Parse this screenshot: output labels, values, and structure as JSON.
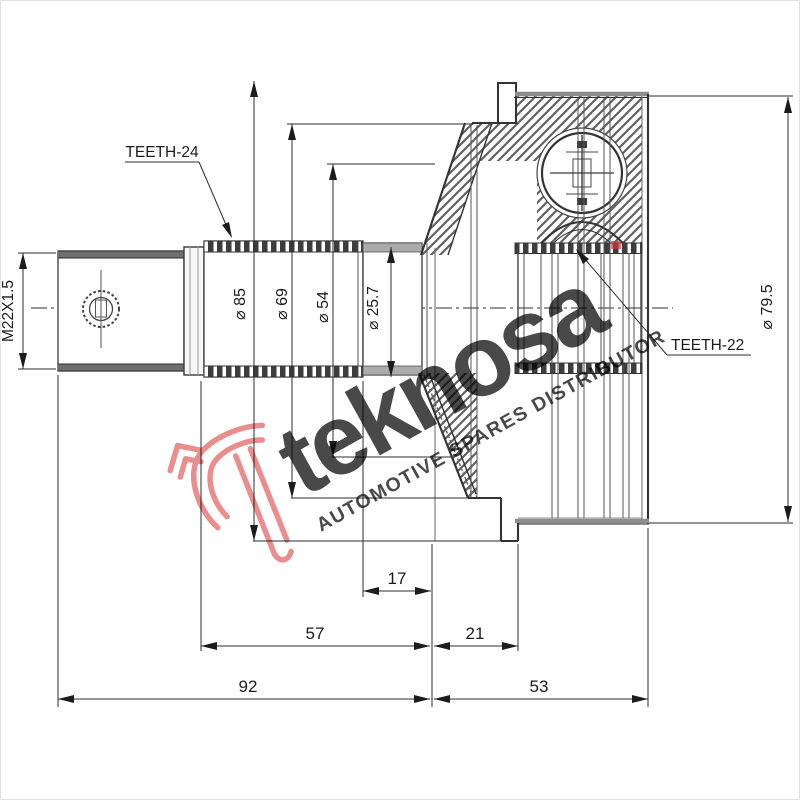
{
  "drawing": {
    "thread_label": "M22X1.5",
    "teeth_label_left": "TEETH-24",
    "teeth_label_right": "TEETH-22",
    "diameters": {
      "d85": "⌀ 85",
      "d69": "⌀ 69",
      "d54": "⌀ 54",
      "d25_7": "⌀ 25.7",
      "d79_5": "⌀ 79.5"
    },
    "lengths": {
      "l17": "17",
      "l57": "57",
      "l21": "21",
      "l92": "92",
      "l53": "53"
    }
  },
  "watermark": {
    "brand": "teknosa",
    "tagline": "AUTOMOTIVE SPARES DISTRIBUTOR",
    "brand_color": "#ec8080",
    "tagline_color": "#f1a0a0",
    "logo_color": "#e56e6e"
  }
}
